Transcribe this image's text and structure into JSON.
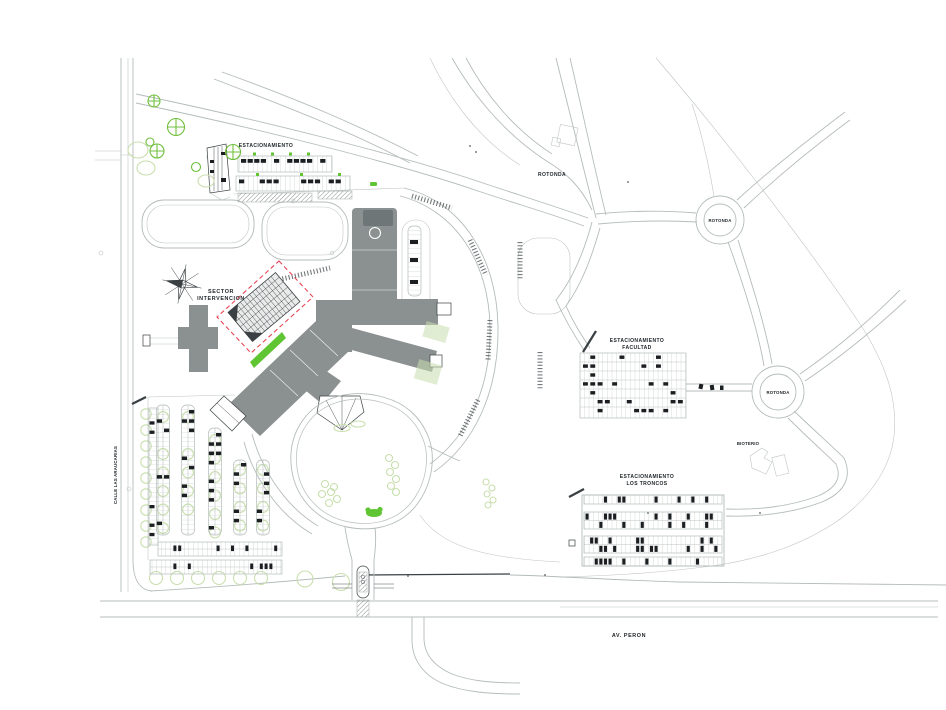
{
  "labels": {
    "estacionamiento_top": "ESTACIONAMIENTO",
    "sector_intervencion": {
      "line1": "SECTOR",
      "line2": "INTERVENCION"
    },
    "rotonda_plain": "ROTONDA",
    "rotonda_circle_1": "ROTONDA",
    "rotonda_circle_2": "ROTONDA",
    "bioterio": "BIOTERIO",
    "estacionamiento_facultad": {
      "line1": "ESTACIONAMIENTO",
      "line2": "FACULTAD"
    },
    "estacionamiento_los_troncos": {
      "line1": "ESTACIONAMIENTO",
      "line2": "LOS TRONCOS"
    },
    "av_peron": "AV. PERON",
    "calle_las_araucarias": "CALLE LAS ARAUCARIAS"
  },
  "colors": {
    "background": "#ffffff",
    "line_gray": "#b4bcba",
    "line_dark": "#3a4043",
    "building_gray": "#8a9190",
    "building_dark": "#6e7677",
    "car_black": "#1b1f21",
    "tree_green": "#6fbf3c",
    "tree_pale": "#c9dfae",
    "grass_green": "#5fc532",
    "red_dashed": "#e84656"
  }
}
